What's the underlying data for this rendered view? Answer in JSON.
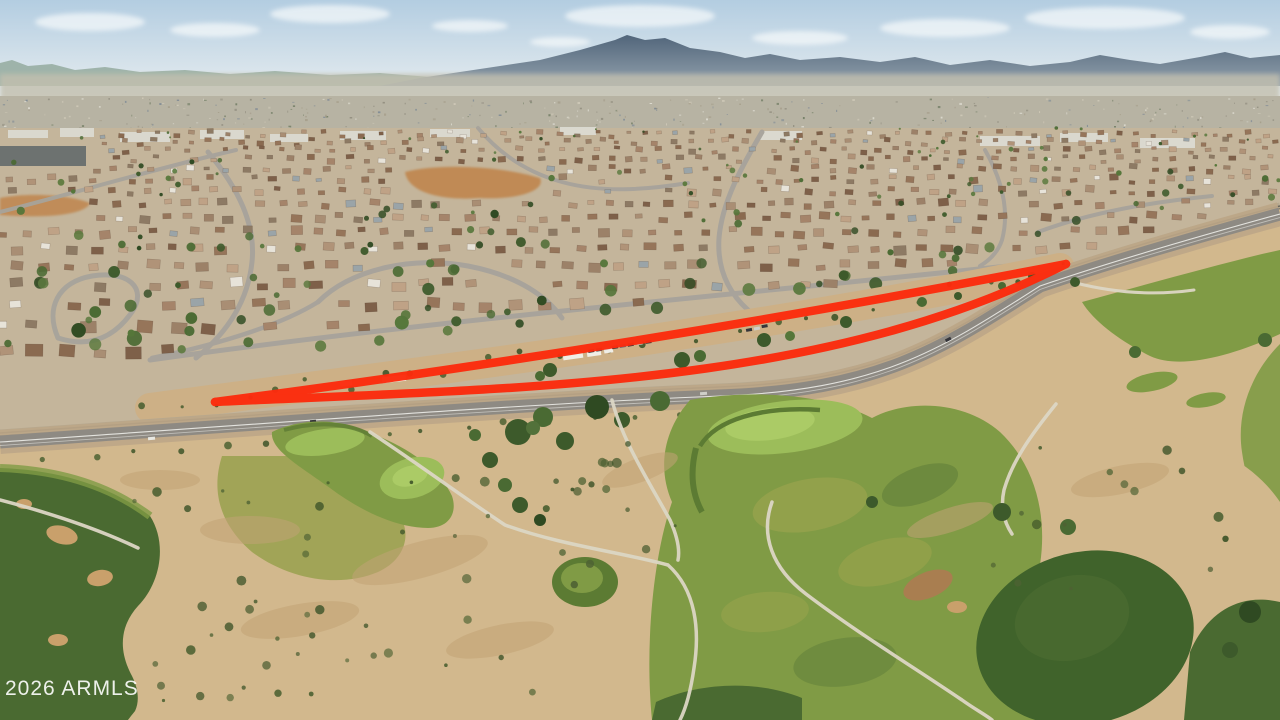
{
  "image": {
    "type": "aerial-photograph",
    "subject": "Drone aerial view of a desert suburban neighborhood and golf course with a vacant land parcel outlined in red along a road and railway corridor, mountains on the horizon"
  },
  "watermark": {
    "text": "2026 ARMLS"
  },
  "annotation": {
    "label": "parcel-boundary-highlight",
    "color": "#fb2c0e",
    "stroke_width": 8.5,
    "top_edge_path": "M215,402 Q650,345 1066,264",
    "bottom_edge_path": "M215,402 C500,388 820,390 1066,264"
  },
  "palette": {
    "sky_top": "#b3cde1",
    "sky_horizon": "#e9eef0",
    "cloud": "#f7fafb",
    "far_ridge": "#8ba394",
    "mountain_top": "#51657a",
    "mountain_base": "#93a2ae",
    "haze": "#c2bfae",
    "city_band": "#b7b3a3",
    "suburb_ground": "#c4b59b",
    "commercial_dark": "#5f6769",
    "commercial_light": "#dfdfd8",
    "street": "#a7a39b",
    "orange_dirt": "#c08348",
    "corridor_dirt": "#cdb086",
    "road_shoulder": "#bca687",
    "asphalt": "#8e8a83",
    "road_line": "#f2f2ee",
    "ballast": "#b6a88f",
    "rail": "#5e5b55",
    "golf_tan": "#d2b88d",
    "tan_streak": "#c2a376",
    "fairway": "#809b45",
    "fairway_olive": "#99a04e",
    "fairway_light": "#a8a851",
    "green_bright": "#9cbd5a",
    "green_core": "#abcb66",
    "green_collar": "#5c7b33",
    "dark_green": "#4a6a31",
    "dark_green2": "#40632b",
    "bunker": "#c9a06b",
    "bunker_dark": "#a97e50",
    "path": "#dcd6c5",
    "bush_dark": "#3e5429",
    "bush_mid": "#4e6233",
    "tree_dark": "#3d5a2b",
    "white_structure": "#f0eee6",
    "vehicle_dark": "#35353a",
    "roof_colors": [
      "#96755a",
      "#8a6a50",
      "#a5846a",
      "#b09378",
      "#7e6049",
      "#a98e74",
      "#bfa286",
      "#8d7a64",
      "#9c8168"
    ],
    "roof_accent": [
      "#e7e3d9",
      "#9aa4a8"
    ],
    "tree_colors": [
      "#3d5a2b",
      "#4a6a33",
      "#55763a",
      "#2f4a22",
      "#5d7a3f"
    ],
    "speck_colors": [
      "#e4e2d8",
      "#8f8b7d",
      "#6f7b62",
      "#cfc9b8",
      "#a59d8a",
      "#7c8894"
    ]
  },
  "scene": {
    "regions": [
      "sky",
      "clouds",
      "mountain-range",
      "distant-city",
      "residential-neighborhood",
      "graded-dirt",
      "frontage-road",
      "vacant-parcel",
      "railway",
      "main-road",
      "golf-course",
      "desert-waste",
      "fairways",
      "putting-greens",
      "sand-bunkers",
      "cart-paths"
    ]
  }
}
